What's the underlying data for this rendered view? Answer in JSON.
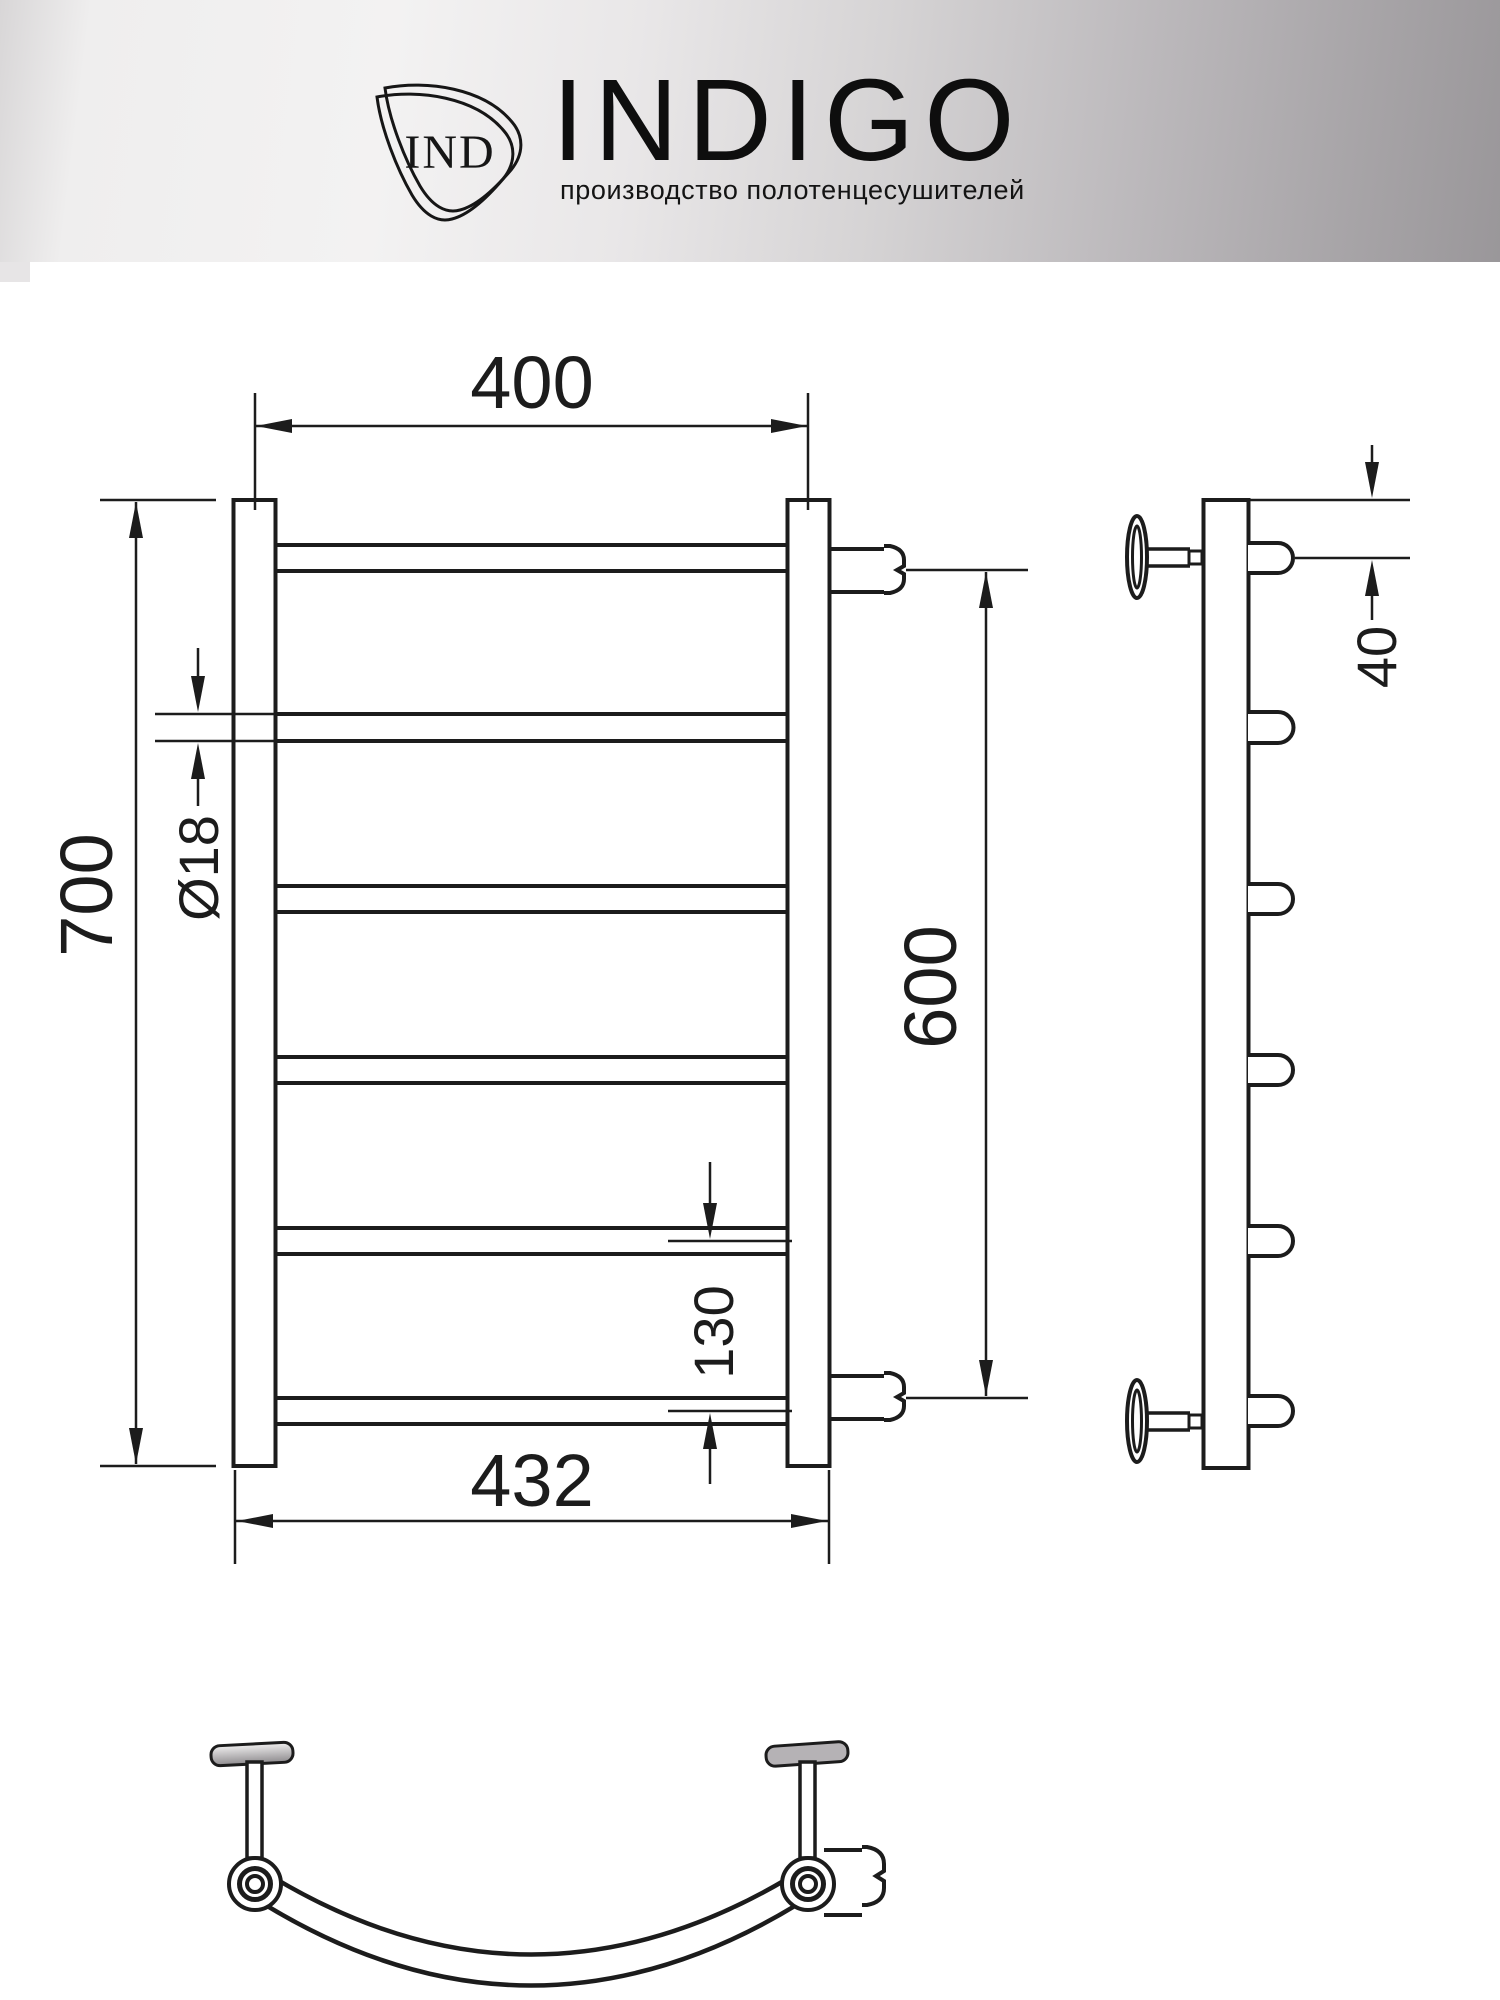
{
  "header": {
    "brand": "INDIGO",
    "logo_monogram": "IND",
    "tagline": "производство полотенцесушителей"
  },
  "drawing": {
    "type": "towel-rail technical drawing, front / side / bottom views",
    "dimensions": {
      "top_width": "400",
      "overall_height": "700",
      "tube_diameter": "Ø18",
      "connection_spacing": "600",
      "bottom_tube_spacing": "130",
      "overall_width": "432",
      "wall_offset": "40"
    },
    "colors": {
      "line": "#1c1c1c",
      "background": "#ffffff"
    }
  }
}
